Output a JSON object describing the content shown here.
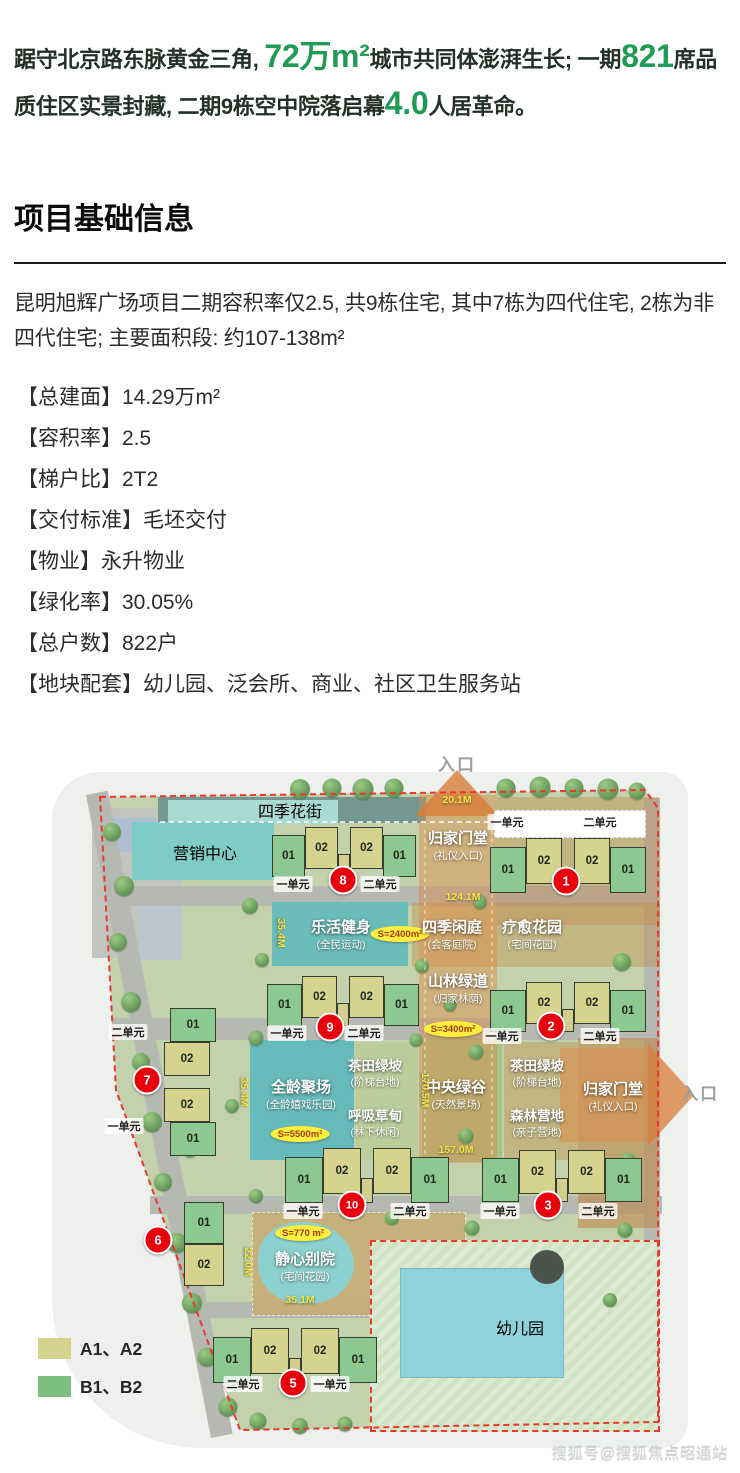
{
  "hero": {
    "s1": "踞守北京路东脉黄金三角, ",
    "s2": "72万m²",
    "s3": "城市共同体澎湃生长; 一期",
    "s4": "821",
    "s5": "席品质住区实景封藏, 二期9栋空中院落启幕",
    "s6": "4.0",
    "s7": "人居革命。",
    "accent_color": "#1f9b54"
  },
  "section": {
    "title": "项目基础信息"
  },
  "info": {
    "intro": "昆明旭辉广场项目二期容积率仅2.5, 共9栋住宅, 其中7栋为四代住宅, 2栋为非四代住宅; 主要面积段: 约107-138m²",
    "items": [
      "【总建面】14.29万m²",
      "【容积率】2.5",
      "【梯户比】2T2",
      "【交付标准】毛坯交付",
      "【物业】永升物业",
      "【绿化率】30.05%",
      "【总户数】822户",
      "【地块配套】幼儿园、泛会所、商业、社区卫生服务站"
    ]
  },
  "map": {
    "entrance_top": "入口",
    "entrance_right": "入口",
    "labels": [
      {
        "id": "dim-20-1",
        "text": "20.1M",
        "cls": "dim"
      },
      {
        "id": "street",
        "text": "四季花街",
        "cls": "mlabel area-md"
      },
      {
        "id": "marketing",
        "text": "营销中心",
        "cls": "mlabel area-lg"
      },
      {
        "id": "gate-top",
        "text": "归家门堂",
        "sub": "(礼仪入口)",
        "cls": "mlabel area-lg"
      },
      {
        "id": "dim-124-1",
        "text": "124.1M",
        "cls": "dim"
      },
      {
        "id": "dim-35-4a",
        "text": "35.4M",
        "cls": "dim vert"
      },
      {
        "id": "lehuo",
        "text": "乐活健身",
        "sub": "(全民运动)",
        "cls": "mlabel area-lg"
      },
      {
        "id": "s2400",
        "text": "S=2400m²",
        "cls": "sbadge"
      },
      {
        "id": "siji",
        "text": "四季闲庭",
        "sub": "(会客庭院)",
        "cls": "mlabel area-lg"
      },
      {
        "id": "liaoyu",
        "text": "疗愈花园",
        "sub": "(宅间花园)",
        "cls": "mlabel area-lg"
      },
      {
        "id": "shanlin",
        "text": "山林绿道",
        "sub": "(归家林荫)",
        "cls": "mlabel area-lg"
      },
      {
        "id": "s3400",
        "text": "S=3400m²",
        "cls": "sbadge"
      },
      {
        "id": "dim-35-4b",
        "text": "35.4M",
        "cls": "dim vert"
      },
      {
        "id": "quanling",
        "text": "全龄聚场",
        "sub": "(全龄嬉戏乐园)",
        "cls": "mlabel area-lg"
      },
      {
        "id": "s5500",
        "text": "S=5500m²",
        "cls": "sbadge"
      },
      {
        "id": "chatian-a",
        "text": "茶田绿坡",
        "sub": "(阶梯台地)",
        "cls": "mlabel area-md"
      },
      {
        "id": "huxi",
        "text": "呼吸草甸",
        "sub": "(林下休闲)",
        "cls": "mlabel area-md"
      },
      {
        "id": "zhongyang",
        "text": "中央绿谷",
        "sub": "(天然景场)",
        "cls": "mlabel area-lg"
      },
      {
        "id": "dim-170-5",
        "text": "170.5M",
        "cls": "dim vert"
      },
      {
        "id": "chatian-b",
        "text": "茶田绿坡",
        "sub": "(阶梯台地)",
        "cls": "mlabel area-md"
      },
      {
        "id": "senlin",
        "text": "森林营地",
        "sub": "(亲子营地)",
        "cls": "mlabel area-md"
      },
      {
        "id": "gate-right",
        "text": "归家门堂",
        "sub": "(礼仪入口)",
        "cls": "mlabel area-lg"
      },
      {
        "id": "dim-157-0",
        "text": "157.0M",
        "cls": "dim"
      },
      {
        "id": "jingxin",
        "text": "静心别院",
        "sub": "(宅间花园)",
        "cls": "mlabel area-lg"
      },
      {
        "id": "s770",
        "text": "S=770 m²",
        "cls": "sbadge"
      },
      {
        "id": "dim-22-0",
        "text": "22.0M",
        "cls": "dim vert"
      },
      {
        "id": "dim-35-1",
        "text": "35.1M",
        "cls": "dim"
      },
      {
        "id": "kindergarten",
        "text": "幼儿园",
        "cls": "mlabel area-lg"
      }
    ],
    "buildings": [
      {
        "no": "8",
        "units": [
          "01",
          "02",
          "02",
          "01"
        ],
        "group_labels": [
          "一单元",
          "二单元"
        ]
      },
      {
        "no": "1",
        "units": [
          "01",
          "02",
          "02",
          "01"
        ],
        "group_labels": [
          "一单元",
          "二单元"
        ]
      },
      {
        "no": "9",
        "units": [
          "01",
          "02",
          "02",
          "01"
        ],
        "group_labels": [
          "一单元",
          "二单元"
        ]
      },
      {
        "no": "2",
        "units": [
          "01",
          "02",
          "02",
          "01"
        ],
        "group_labels": [
          "一单元",
          "二单元"
        ]
      },
      {
        "no": "7",
        "units": [
          "01",
          "02",
          "02",
          "01"
        ],
        "group_labels": [
          "二单元",
          "一单元"
        ]
      },
      {
        "no": "10",
        "units": [
          "01",
          "02",
          "02",
          "01"
        ],
        "group_labels": [
          "一单元",
          "二单元"
        ]
      },
      {
        "no": "3",
        "units": [
          "01",
          "02",
          "02",
          "01"
        ],
        "group_labels": [
          "一单元",
          "二单元"
        ]
      },
      {
        "no": "6",
        "units": [
          "01",
          "02"
        ],
        "group_labels": []
      },
      {
        "no": "5",
        "units": [
          "01",
          "02",
          "02",
          "01"
        ],
        "group_labels": [
          "二单元",
          "一单元"
        ]
      }
    ],
    "legend": [
      {
        "swatch": "#d6d38f",
        "label": "A1、A2"
      },
      {
        "swatch": "#7cbf7e",
        "label": "B1、B2"
      }
    ],
    "colors": {
      "unit_a": "#d6d38f",
      "unit_b": "#8cc88f",
      "marker": "#e8000d",
      "dim": "#f6e63c",
      "axis": "#dd8a45"
    }
  },
  "watermark": "搜狐号@搜狐焦点昭通站"
}
